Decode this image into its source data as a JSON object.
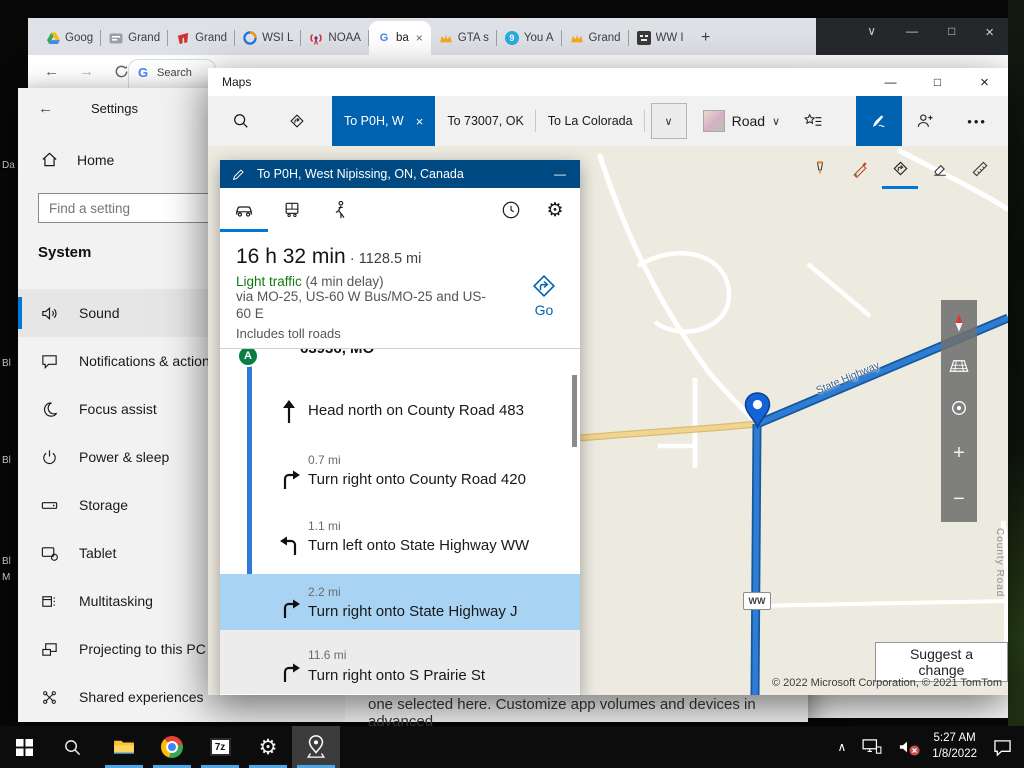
{
  "glyphs": {
    "back": "←",
    "forward": "→",
    "minimize": "—",
    "maximize": "□",
    "close": "×",
    "chevron_down": "∨",
    "chevron_up": "∧",
    "plus": "+",
    "minus": "−",
    "ellipsis": "•••",
    "gear": "⚙",
    "google_g": "G",
    "new_tab": "+",
    "nine": "9",
    "seven_zip": "7z"
  },
  "desktop": {
    "icon_labels": [
      "Da",
      "Bl",
      "Bl",
      "Bl",
      "M"
    ]
  },
  "chrome": {
    "tabs": [
      {
        "label": "Goog"
      },
      {
        "label": "Grand"
      },
      {
        "label": "Grand"
      },
      {
        "label": "WSI L"
      },
      {
        "label": "NOAA"
      },
      {
        "label": "ba",
        "active": true
      },
      {
        "label": "GTA s"
      },
      {
        "label": "You A"
      },
      {
        "label": "Grand"
      },
      {
        "label": "WW I"
      }
    ],
    "page_fragment_label": "Search"
  },
  "settings": {
    "title": "Settings",
    "home": "Home",
    "search_placeholder": "Find a setting",
    "section_title": "System",
    "nav": [
      "Sound",
      "Notifications & actions",
      "Focus assist",
      "Power & sleep",
      "Storage",
      "Tablet",
      "Multitasking",
      "Projecting to this PC",
      "Shared experiences"
    ],
    "selected_item": "Sound",
    "footer_fragment": "one selected here. Customize app volumes and devices in advanced"
  },
  "maps": {
    "window_title": "Maps",
    "toolbar": {
      "tabs": [
        {
          "label": "To P0H, W",
          "active": true
        },
        {
          "label": "To 73007, OK"
        },
        {
          "label": "To La Colorada"
        }
      ],
      "road_label": "Road"
    },
    "directions": {
      "destination": "To P0H, West Nipissing, ON, Canada",
      "duration": "16 h 32 min",
      "separator": "·",
      "distance": "1128.5 mi",
      "traffic_status": "Light traffic",
      "traffic_delay": " (4 min delay)",
      "via_route": "via MO-25, US-60 W Bus/MO-25 and US-60 E",
      "toll_note": "Includes toll roads",
      "go_label": "Go",
      "origin_marker": "A",
      "origin_text": "63936, MO",
      "steps": [
        {
          "distance": "",
          "instruction": "Head north on County Road 483",
          "maneuver": "straight"
        },
        {
          "distance": "0.7 mi",
          "instruction": "Turn right onto County Road 420",
          "maneuver": "right"
        },
        {
          "distance": "1.1 mi",
          "instruction": "Turn left onto State Highway WW",
          "maneuver": "left"
        },
        {
          "distance": "2.2 mi",
          "instruction": "Turn right onto State Highway J",
          "maneuver": "right",
          "selected": true
        },
        {
          "distance": "11.6 mi",
          "instruction": "Turn right onto S Prairie St",
          "maneuver": "right"
        }
      ]
    },
    "map": {
      "route_label": "State Highway",
      "shield": "WW",
      "county_label": "County Road",
      "suggest_button": "Suggest a change",
      "copyright": "© 2022 Microsoft Corporation, © 2021 TomTom"
    }
  },
  "taskbar": {
    "time": "5:27 AM",
    "date": "1/8/2022"
  },
  "colors": {
    "accent": "#0078d7",
    "maps_tab_blue": "#0063b1",
    "directions_header_blue": "#004a83",
    "route_blue": "#2e7cd4",
    "selected_step_blue": "#a9d3f3",
    "traffic_green": "#107c10"
  }
}
